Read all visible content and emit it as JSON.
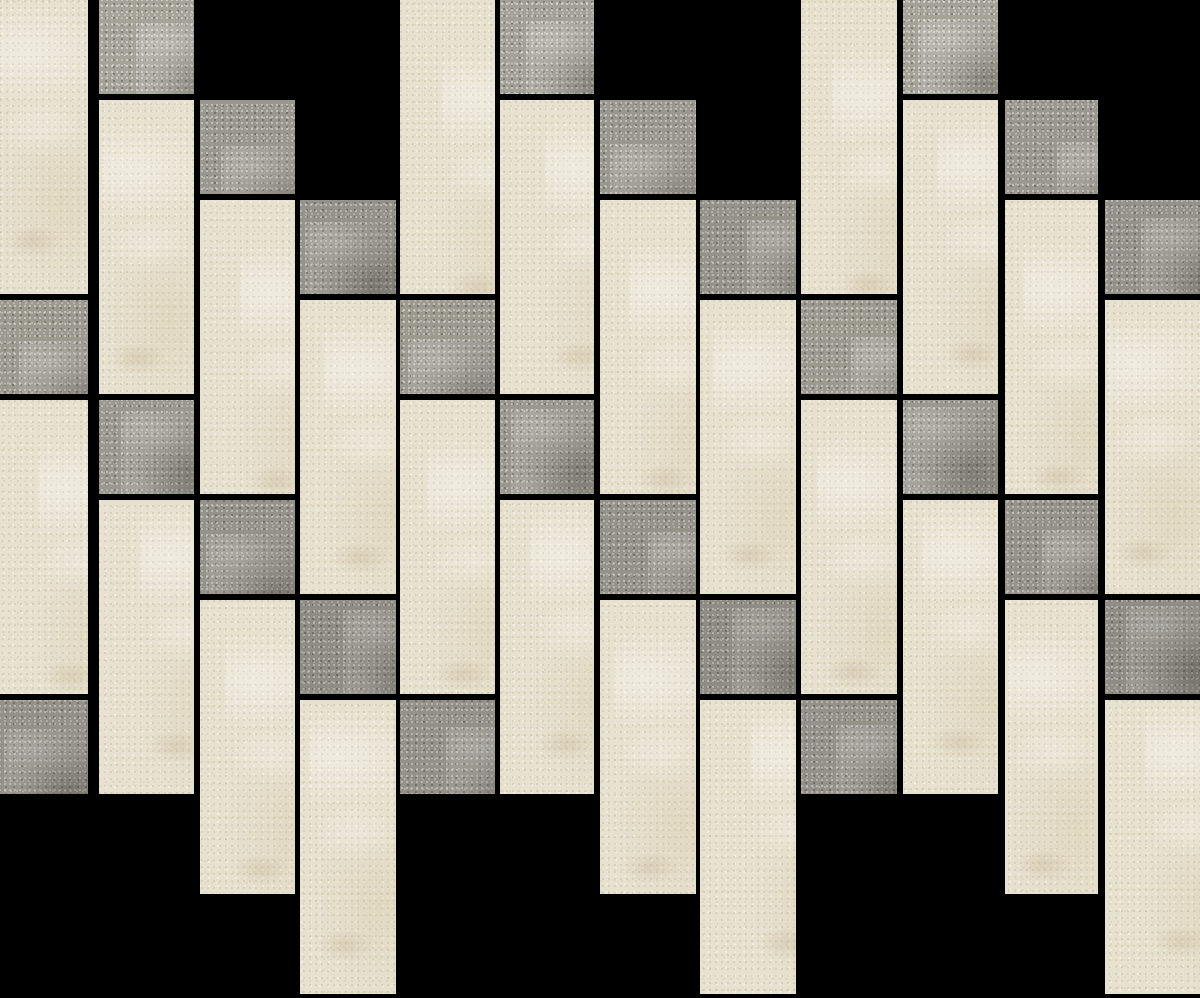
{
  "canvas": {
    "width": 1200,
    "height": 998,
    "background": "#000000"
  },
  "mosaic": {
    "description": "Vertical brick mosaic tile sheet: cream limestone rectangles with scattered grey stone squares, black grout, staggered columns",
    "palette": {
      "cream": "#e7e1d0",
      "cream_speckle_light": "#f6f2e7",
      "cream_speckle_dark": "#ab976e",
      "gray": "#9a978e",
      "gray_speckle_light": "#f2f1eb",
      "gray_speckle_dark": "#32302a",
      "grout": "#000000"
    },
    "tile": {
      "width_px": 95,
      "tall_height_px": 294,
      "square_height_px": 94,
      "grout_px": 6,
      "column_pitch_px": 100,
      "row_period_px": 400,
      "column_stagger_px": 100
    },
    "columns": [
      {
        "x": 0,
        "w": 88,
        "bricks": [
          {
            "shape": "tall",
            "shade": "cream",
            "y": 0,
            "h": 294
          },
          {
            "shape": "square",
            "shade": "gray",
            "y": 300,
            "h": 94,
            "tone": 1.01
          },
          {
            "shape": "tall",
            "shade": "cream",
            "y": 400,
            "h": 294
          },
          {
            "shape": "square",
            "shade": "gray",
            "y": 700,
            "h": 94,
            "tone": 0.96
          }
        ]
      },
      {
        "x": 99,
        "w": 95,
        "bricks": [
          {
            "shape": "square",
            "shade": "gray",
            "y": 0,
            "h": 94,
            "tone": 1.07
          },
          {
            "shape": "tall",
            "shade": "cream",
            "y": 100,
            "h": 294
          },
          {
            "shape": "square",
            "shade": "gray",
            "y": 400,
            "h": 94,
            "tone": 1.0
          },
          {
            "shape": "tall",
            "shade": "cream",
            "y": 500,
            "h": 294
          }
        ]
      },
      {
        "x": 200,
        "w": 95,
        "bricks": [
          {
            "shape": "square",
            "shade": "gray",
            "y": 100,
            "h": 94,
            "tone": 1.0
          },
          {
            "shape": "tall",
            "shade": "cream",
            "y": 200,
            "h": 294
          },
          {
            "shape": "square",
            "shade": "gray",
            "y": 500,
            "h": 94,
            "tone": 0.97
          },
          {
            "shape": "tall",
            "shade": "cream",
            "y": 600,
            "h": 294
          }
        ]
      },
      {
        "x": 300,
        "w": 96,
        "bricks": [
          {
            "shape": "square",
            "shade": "gray",
            "y": 200,
            "h": 94,
            "tone": 0.97
          },
          {
            "shape": "tall",
            "shade": "cream",
            "y": 300,
            "h": 294
          },
          {
            "shape": "square",
            "shade": "gray",
            "y": 600,
            "h": 94,
            "tone": 0.93
          },
          {
            "shape": "tall",
            "shade": "cream",
            "y": 700,
            "h": 294
          }
        ]
      },
      {
        "x": 400,
        "w": 95,
        "bricks": [
          {
            "shape": "tall",
            "shade": "cream",
            "y": 0,
            "h": 294
          },
          {
            "shape": "square",
            "shade": "gray",
            "y": 300,
            "h": 94,
            "tone": 1.01
          },
          {
            "shape": "tall",
            "shade": "cream",
            "y": 400,
            "h": 294
          },
          {
            "shape": "square",
            "shade": "gray",
            "y": 700,
            "h": 94,
            "tone": 0.96
          }
        ]
      },
      {
        "x": 500,
        "w": 94,
        "bricks": [
          {
            "shape": "square",
            "shade": "gray",
            "y": 0,
            "h": 94,
            "tone": 1.06
          },
          {
            "shape": "tall",
            "shade": "cream",
            "y": 100,
            "h": 294
          },
          {
            "shape": "square",
            "shade": "gray",
            "y": 400,
            "h": 94,
            "tone": 1.0
          },
          {
            "shape": "tall",
            "shade": "cream",
            "y": 500,
            "h": 294
          }
        ]
      },
      {
        "x": 600,
        "w": 96,
        "bricks": [
          {
            "shape": "square",
            "shade": "gray",
            "y": 100,
            "h": 94,
            "tone": 1.0
          },
          {
            "shape": "tall",
            "shade": "cream",
            "y": 200,
            "h": 294
          },
          {
            "shape": "square",
            "shade": "gray",
            "y": 500,
            "h": 94,
            "tone": 0.97
          },
          {
            "shape": "tall",
            "shade": "cream",
            "y": 600,
            "h": 294
          }
        ]
      },
      {
        "x": 700,
        "w": 96,
        "bricks": [
          {
            "shape": "square",
            "shade": "gray",
            "y": 200,
            "h": 94,
            "tone": 0.97
          },
          {
            "shape": "tall",
            "shade": "cream",
            "y": 300,
            "h": 294
          },
          {
            "shape": "square",
            "shade": "gray",
            "y": 600,
            "h": 94,
            "tone": 0.93
          },
          {
            "shape": "tall",
            "shade": "cream",
            "y": 700,
            "h": 294
          }
        ]
      },
      {
        "x": 801,
        "w": 96,
        "bricks": [
          {
            "shape": "tall",
            "shade": "cream",
            "y": 0,
            "h": 294
          },
          {
            "shape": "square",
            "shade": "gray",
            "y": 300,
            "h": 94,
            "tone": 1.01
          },
          {
            "shape": "tall",
            "shade": "cream",
            "y": 400,
            "h": 294
          },
          {
            "shape": "square",
            "shade": "gray",
            "y": 700,
            "h": 94,
            "tone": 0.96
          }
        ]
      },
      {
        "x": 903,
        "w": 95,
        "bricks": [
          {
            "shape": "square",
            "shade": "gray",
            "y": 0,
            "h": 94,
            "tone": 1.07
          },
          {
            "shape": "tall",
            "shade": "cream",
            "y": 100,
            "h": 294
          },
          {
            "shape": "square",
            "shade": "gray",
            "y": 400,
            "h": 94,
            "tone": 1.0
          },
          {
            "shape": "tall",
            "shade": "cream",
            "y": 500,
            "h": 294
          }
        ]
      },
      {
        "x": 1005,
        "w": 93,
        "bricks": [
          {
            "shape": "square",
            "shade": "gray",
            "y": 100,
            "h": 94,
            "tone": 1.0
          },
          {
            "shape": "tall",
            "shade": "cream",
            "y": 200,
            "h": 294
          },
          {
            "shape": "square",
            "shade": "gray",
            "y": 500,
            "h": 94,
            "tone": 0.97
          },
          {
            "shape": "tall",
            "shade": "cream",
            "y": 600,
            "h": 294
          }
        ]
      },
      {
        "x": 1105,
        "w": 95,
        "bricks": [
          {
            "shape": "square",
            "shade": "gray",
            "y": 200,
            "h": 94,
            "tone": 0.97
          },
          {
            "shape": "tall",
            "shade": "cream",
            "y": 300,
            "h": 294
          },
          {
            "shape": "square",
            "shade": "gray",
            "y": 600,
            "h": 94,
            "tone": 0.93
          },
          {
            "shape": "tall",
            "shade": "cream",
            "y": 700,
            "h": 294
          }
        ]
      }
    ]
  }
}
